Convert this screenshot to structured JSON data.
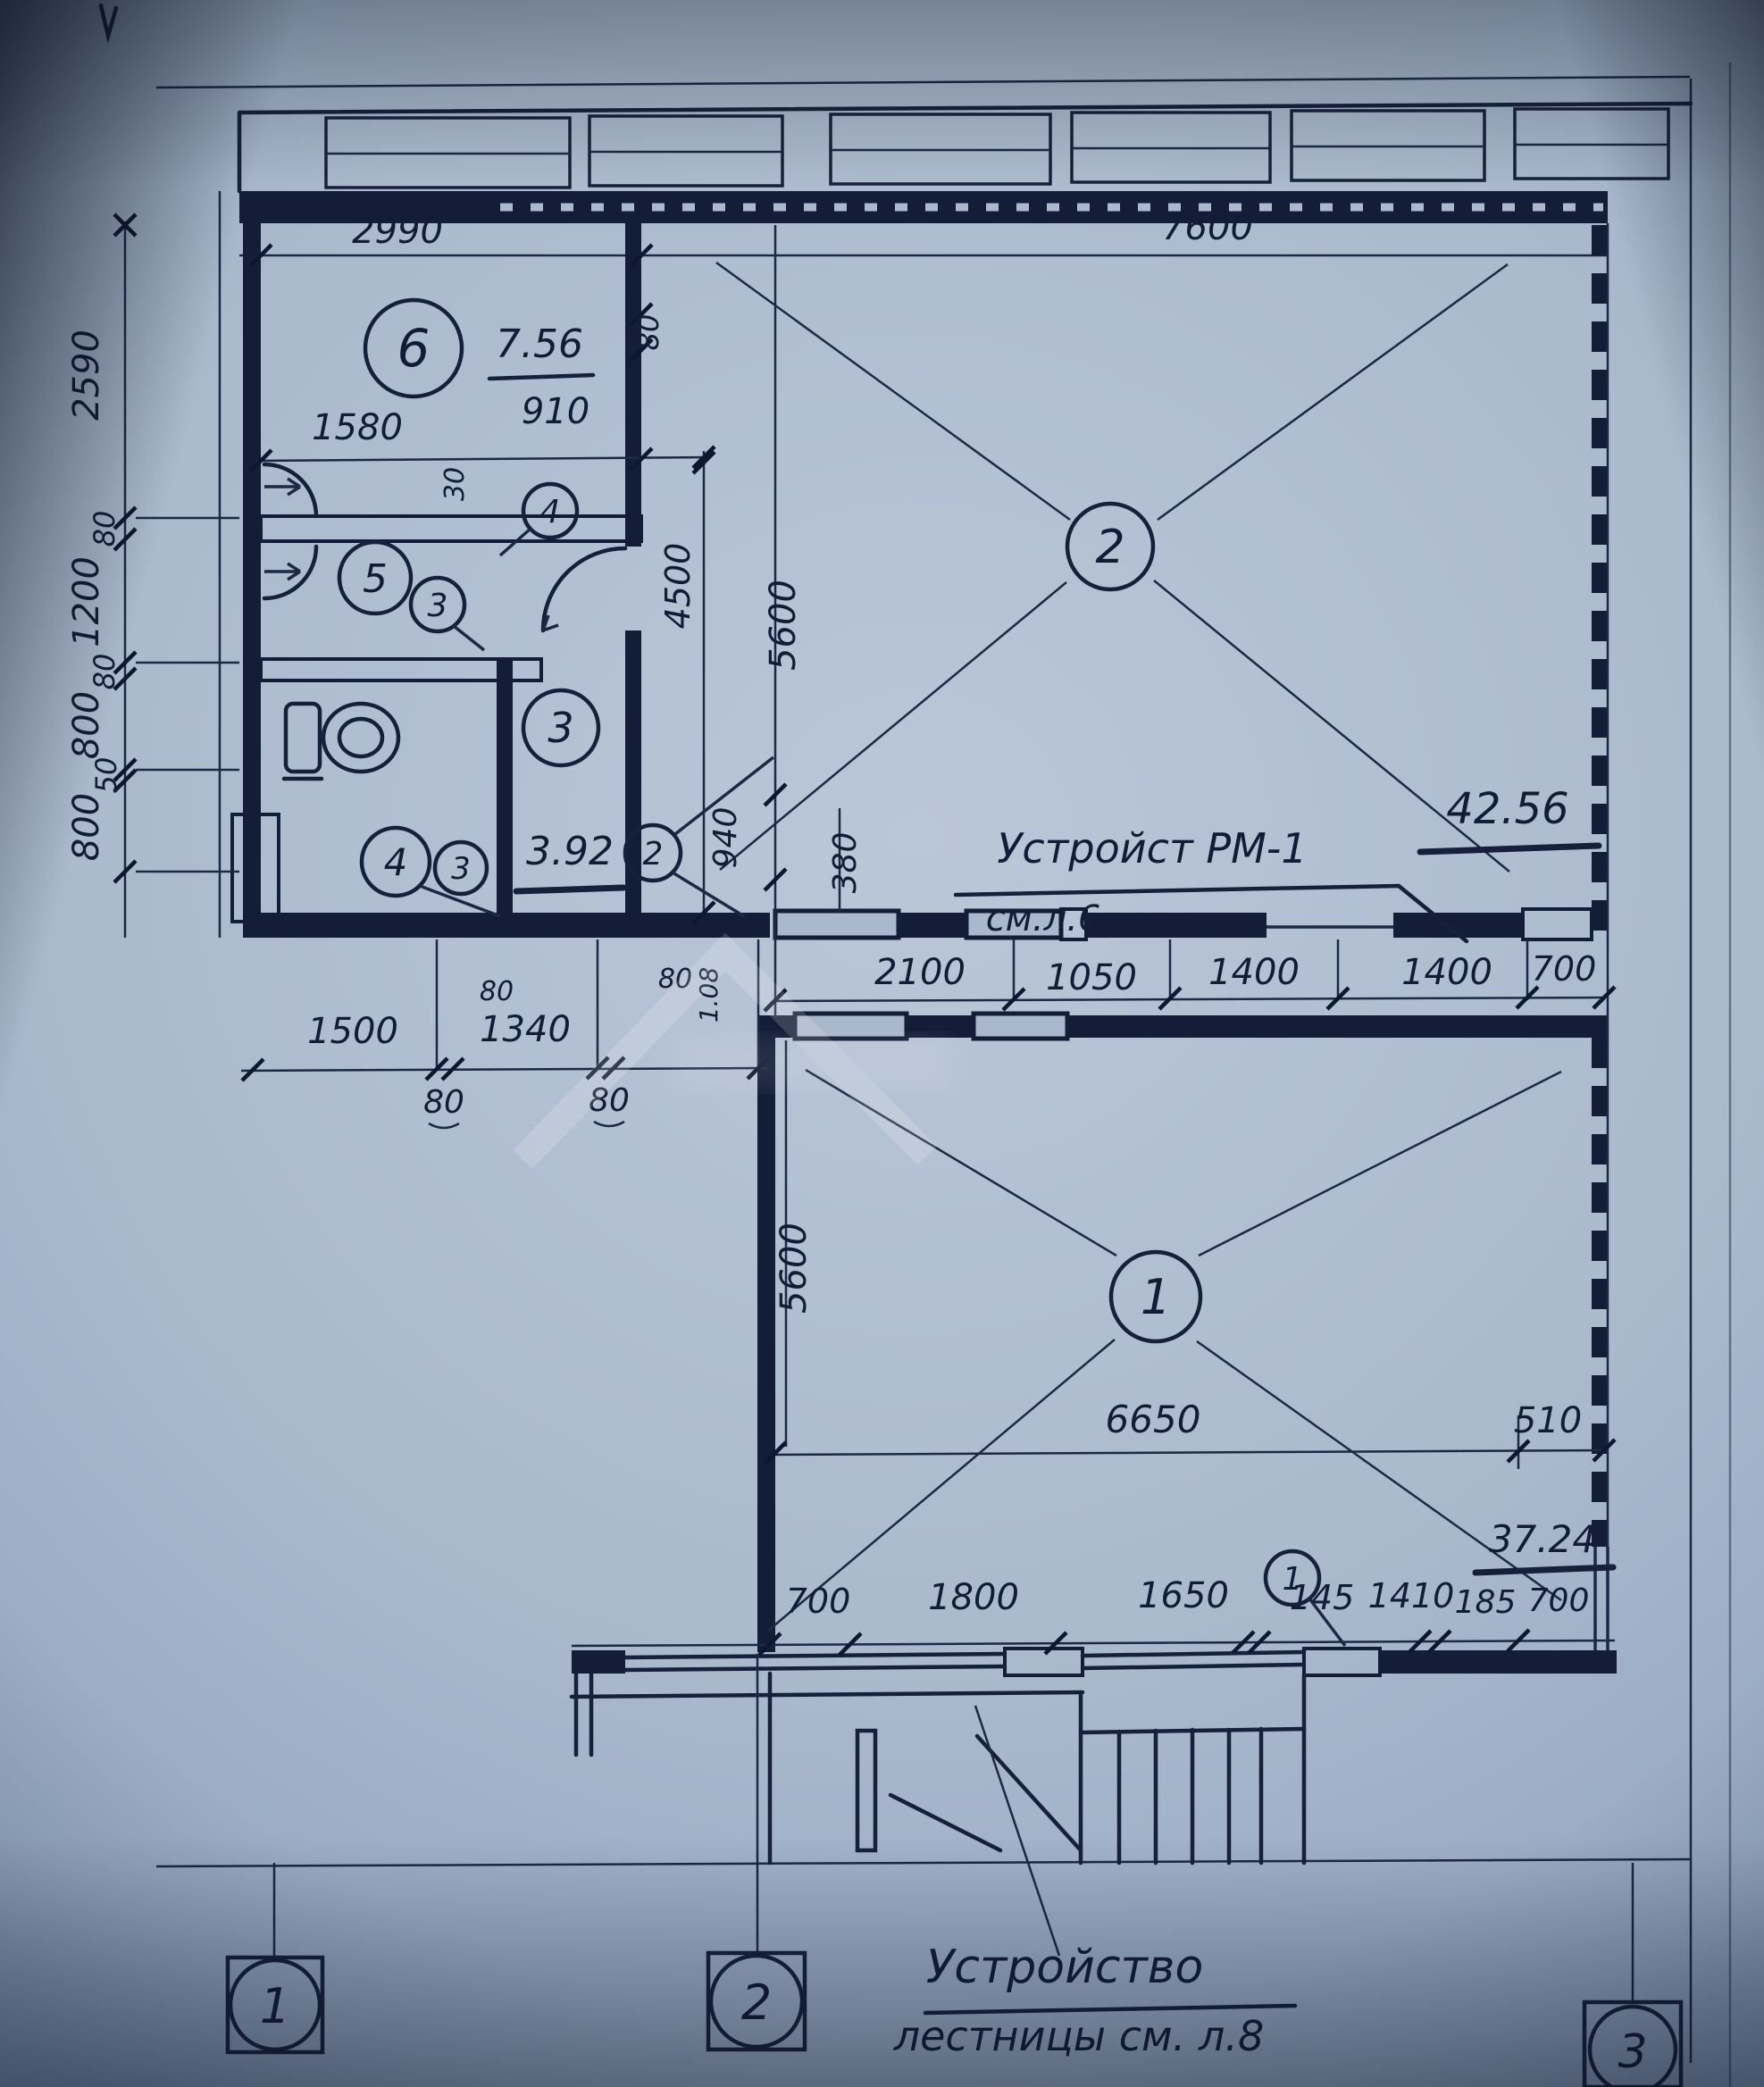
{
  "ink": "#16203a",
  "paper": "#aebfd3",
  "notes": {
    "center_line1": "Устройст РМ-1",
    "center_line2": "см.л.6",
    "bottom_line1": "Устройство",
    "bottom_line2": "лестницы см. л.8"
  },
  "axes": {
    "a1": "1",
    "a2": "2",
    "a3": "3"
  },
  "rooms": {
    "r1": {
      "num": "1",
      "area": "37.24"
    },
    "r2": {
      "num": "2",
      "area": "42.56"
    },
    "r3": {
      "num": "3"
    },
    "r4_upper": {
      "num": "4"
    },
    "r4_lower": {
      "num": "4"
    },
    "r5": {
      "num": "5"
    },
    "r6": {
      "num": "6",
      "area": "7.56"
    },
    "detail3_upper": {
      "num": "3"
    },
    "detail3_lower": {
      "num": "3"
    },
    "detail2": {
      "num": "2",
      "area": "3.92"
    },
    "window1": {
      "num": "1"
    }
  },
  "dims": {
    "top": {
      "left": "2990",
      "right": "7600",
      "wall80": "80"
    },
    "left_chain": {
      "v2590": "2590",
      "v80a": "80",
      "v1200": "1200",
      "v80b": "80",
      "v800a": "800",
      "v50": "50",
      "v800b": "800"
    },
    "upper": {
      "w1580": "1580",
      "w910": "910",
      "t30": "30"
    },
    "vertical": {
      "h4500": "4500",
      "h5600": "5600",
      "w940": "940",
      "w380": "380",
      "t80": "80",
      "a108": "1.08",
      "t80c": "80"
    },
    "corridor": {
      "c2100": "2100",
      "c1050": "1050",
      "c1400a": "1400",
      "c1400b": "1400",
      "c700": "700"
    },
    "lower_left": {
      "w1500": "1500",
      "w1340": "1340",
      "t80a": "80",
      "t80b": "80"
    },
    "room1": {
      "h5600": "5600",
      "w6650": "6650",
      "w510": "510"
    },
    "bottom": {
      "b700a": "700",
      "b1800": "1800",
      "b1650": "1650",
      "b145": "145",
      "b1410": "1410",
      "b185": "185",
      "b700b": "700"
    }
  }
}
